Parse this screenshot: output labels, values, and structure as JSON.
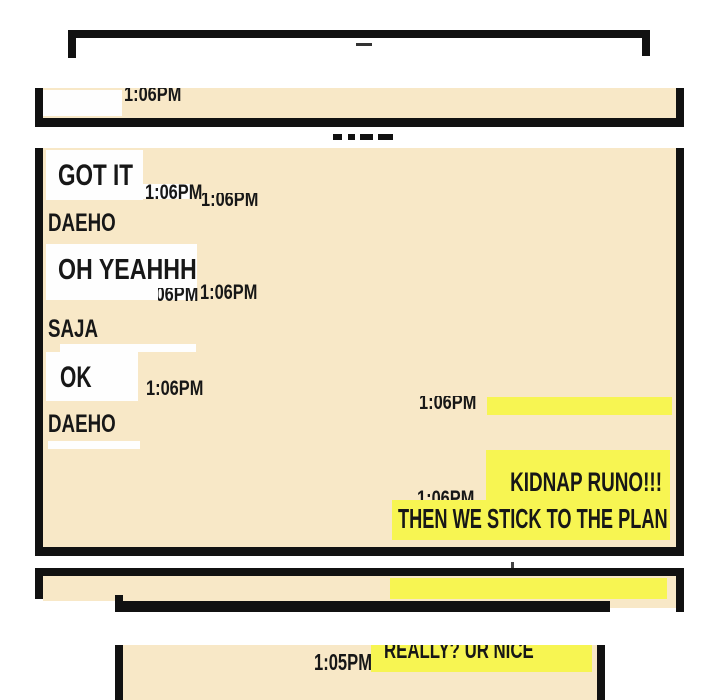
{
  "colors": {
    "page_bg": "#ffffff",
    "panel_bg": "#f8e8c7",
    "bubble_left": "#fefefe",
    "bubble_right": "#f7f552",
    "frame": "#111111",
    "text": "#171717"
  },
  "strip_panel": {
    "time_partial": "1:06PM"
  },
  "main_panel": {
    "messages": {
      "got_it": {
        "text": "GOT IT",
        "time": "1:06PM",
        "time_echo": "1:06PM"
      },
      "sender_1": "DAEHO",
      "oh_yeahhh": {
        "text": "OH YEAHHH",
        "time": "1:06PM",
        "time_echo": "1:06PM"
      },
      "sender_2": "SAJA",
      "ok": {
        "text": "OK",
        "time": "1:06PM"
      },
      "sender_3": "DAEHO",
      "right_bar": {
        "time": "1:06PM"
      },
      "kidnap": {
        "line1": "KIDNAP RUNO!!!",
        "line2": "THEN WE STICK TO THE PLAN",
        "time": "1:06PM"
      }
    }
  },
  "bottom_panel": {
    "really": {
      "text": "REALLY? UR NICE",
      "time": "1:05PM"
    }
  }
}
